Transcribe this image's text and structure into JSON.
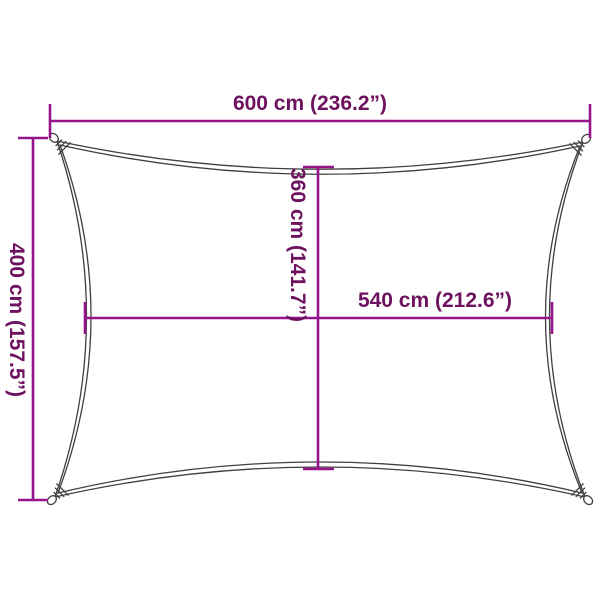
{
  "labels": {
    "top_width": "600 cm (236.2”)",
    "left_height": "400 cm (157.5”)",
    "center_height": "360 cm (141.7”)",
    "center_width": "540 cm (212.6”)"
  },
  "colors": {
    "dimension_line": "#951489",
    "dimension_text": "#6E125F",
    "sail_outline": "#3F3F3F",
    "background": "#FFFFFF"
  }
}
